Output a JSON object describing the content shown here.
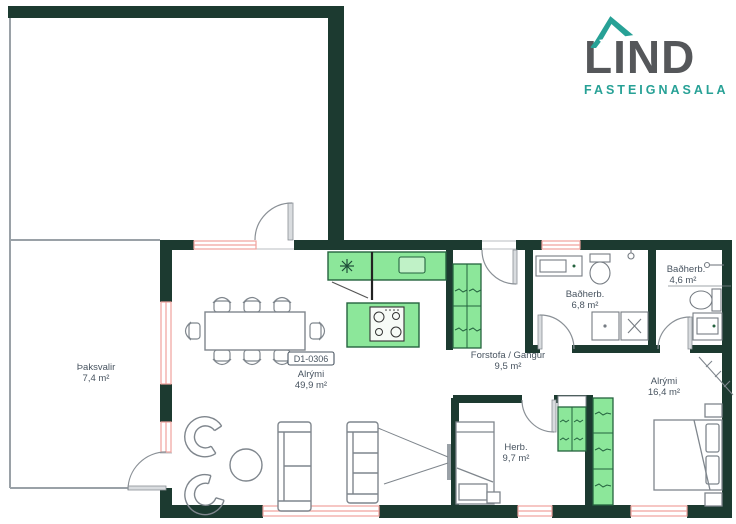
{
  "logo": {
    "brand": "LIND",
    "subtitle": "FASTEIGNASALA",
    "teal": "#27a196",
    "dark_gray": "#55575a"
  },
  "unit": {
    "code": "D1-0306"
  },
  "rooms": {
    "thaksvalir": {
      "name": "Þaksvalir",
      "area": "7,4 m²"
    },
    "alrymi_main": {
      "name": "Alrými",
      "area": "49,9 m²"
    },
    "forstofa": {
      "name": "Forstofa / Gangur",
      "area": "9,5 m²"
    },
    "badherb_6_8": {
      "name": "Baðherb.",
      "area": "6,8 m²"
    },
    "badherb_4_6": {
      "name": "Baðherb.",
      "area": "4,6 m²"
    },
    "alrymi_16": {
      "name": "Alrými",
      "area": "16,4 m²"
    },
    "herb": {
      "name": "Herb.",
      "area": "9,7 m²"
    }
  },
  "colors": {
    "wall": "#1c3a30",
    "furniture_green": "#8ce79a",
    "furniture_green_border": "#25633f",
    "window_pink": "#f0a29d",
    "outline_gray": "#7f868d",
    "railing_gray": "#9aa1a7",
    "label_text": "#485460"
  }
}
